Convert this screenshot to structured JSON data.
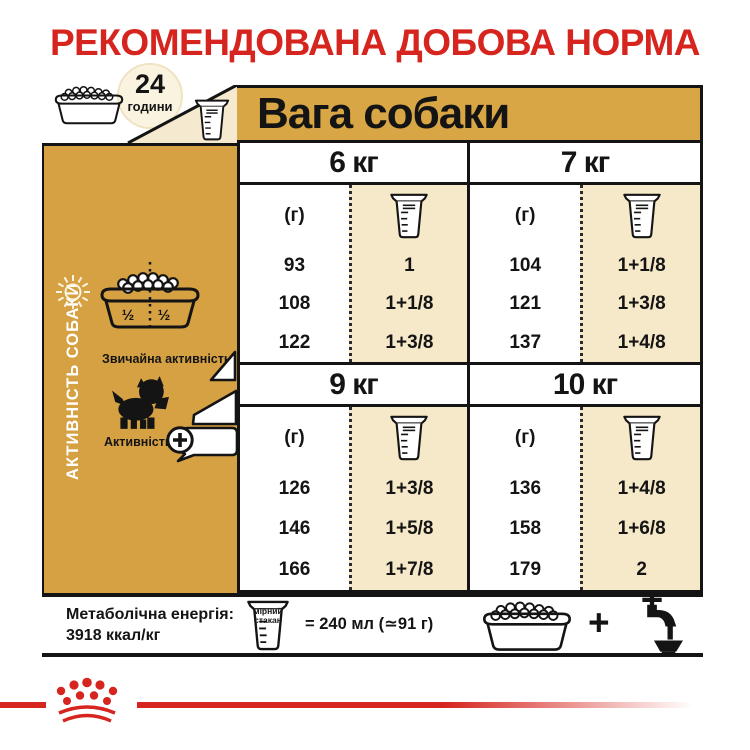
{
  "title": "РЕКОМЕНДОВАНА ДОБОВА НОРМА",
  "colors": {
    "accent_gold": "#d5a143",
    "cream": "#f6e9c9",
    "brand_red": "#d6241e",
    "ink": "#141414"
  },
  "header": {
    "hours_value": "24",
    "hours_label": "години",
    "weight_title": "Вага собаки"
  },
  "sidebar": {
    "vertical_label": "АКТИВНІСТЬ СОБАКИ",
    "bowl_half_left": "½",
    "bowl_half_right": "½",
    "normal_activity_label": "Звичайна активність",
    "high_activity_label": "Активність",
    "high_activity_plus": "+"
  },
  "chart_data": {
    "type": "table",
    "title": "Вага собаки",
    "grams_unit": "(г)",
    "cup_unit": "мірний стакан",
    "activity_levels_shown": [
      "Звичайна активність",
      "Активність +"
    ],
    "sections": [
      {
        "weight": "6 кг",
        "grams": [
          93,
          108,
          122
        ],
        "cups": [
          "1",
          "1+1/8",
          "1+3/8"
        ]
      },
      {
        "weight": "7 кг",
        "grams": [
          104,
          121,
          137
        ],
        "cups": [
          "1+1/8",
          "1+3/8",
          "1+4/8"
        ]
      },
      {
        "weight": "9 кг",
        "grams": [
          126,
          146,
          166
        ],
        "cups": [
          "1+3/8",
          "1+5/8",
          "1+7/8"
        ]
      },
      {
        "weight": "10 кг",
        "grams": [
          136,
          158,
          179
        ],
        "cups": [
          "1+4/8",
          "1+6/8",
          "2"
        ]
      }
    ]
  },
  "footer": {
    "energy_label": "Метаболічна енергія:",
    "energy_value": "3918 ккал/кг",
    "cup_word1": "мірний",
    "cup_word2": "стакан",
    "equivalence": "= 240 мл (≃91 г)",
    "plus": "+"
  }
}
